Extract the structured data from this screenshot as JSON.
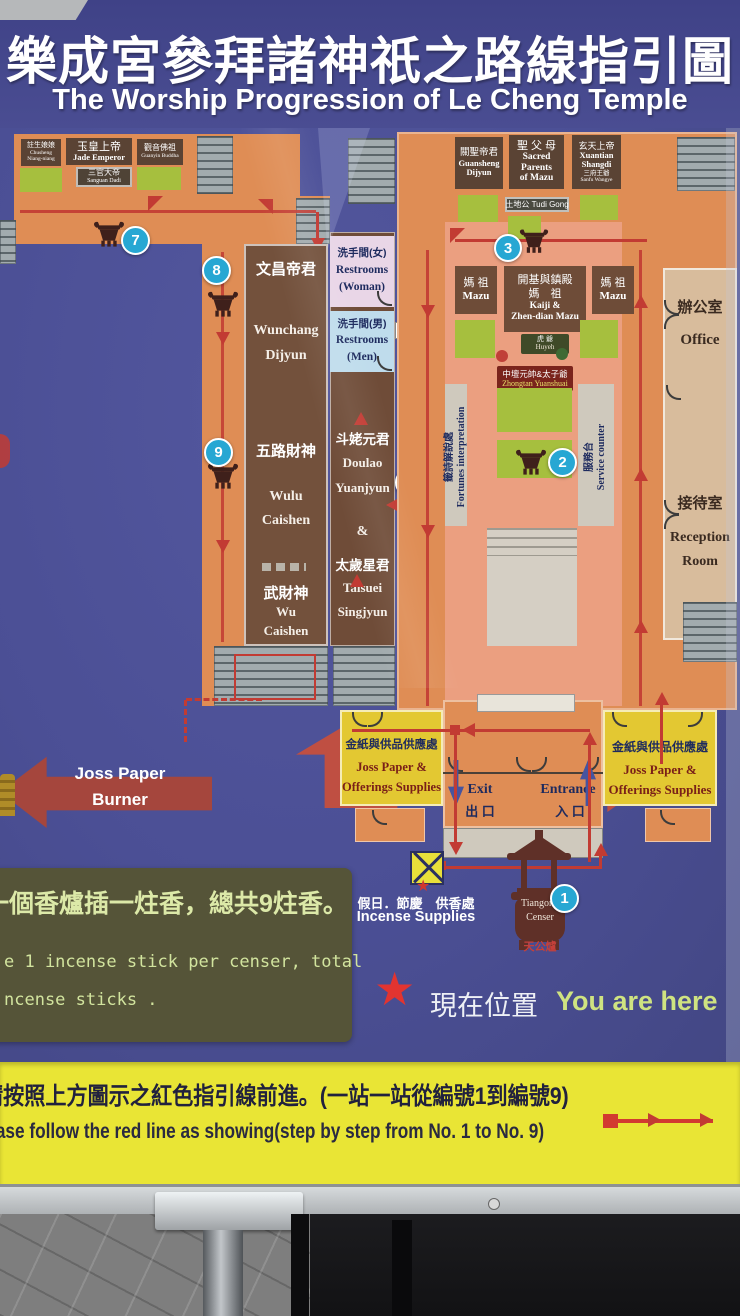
{
  "title": {
    "zh": "樂成宮參拜諸神祇之路線指引圖",
    "en": "The Worship Progression of Le Cheng Temple"
  },
  "left_wing": {
    "deities": [
      {
        "zh": "註生娘娘",
        "en1": "Chusheng",
        "en2": "Niang-niang"
      },
      {
        "zh": "玉皇上帝",
        "en": "Jade Emperor"
      },
      {
        "zh": "觀音佛祖",
        "en": "Guanyin Buddha"
      },
      {
        "zh": "三官大帝",
        "en": "Sanguan Dadi"
      }
    ],
    "hall": {
      "wunchang_zh": "文昌帝君",
      "wunchang_en1": "Wunchang",
      "wunchang_en2": "Dijyun",
      "wulu_zh": "五路財神",
      "wulu_en1": "Wulu",
      "wulu_en2": "Caishen",
      "wu_zh": "武財神",
      "wu_en1": "Wu",
      "wu_en2": "Caishen"
    },
    "floor_2f": "2F",
    "floor_1f": "1F",
    "joss_burner1": "Joss Paper",
    "joss_burner2": "Burner"
  },
  "middle": {
    "restroom_w_zh": "洗手間(女)",
    "restroom_w_en1": "Restrooms",
    "restroom_w_en2": "(Woman)",
    "restroom_m_zh": "洗手間(男)",
    "restroom_m_en1": "Restrooms",
    "restroom_m_en2": "(Men)",
    "doulao_zh": "斗姥元君",
    "doulao_en1": "Doulao",
    "doulao_en2": "Yuanjyun",
    "amp": "&",
    "taisuei_zh": "太歲星君",
    "taisuei_en1": "Taisuei",
    "taisuei_en2": "Singjyun"
  },
  "right_wing": {
    "guansheng": {
      "zh": "關聖帝君",
      "en1": "Guansheng",
      "en2": "Dijyun"
    },
    "parents": {
      "zh": "聖 父 母",
      "en1": "Sacred",
      "en2": "Parents",
      "en3": "of Mazu"
    },
    "xuantian": {
      "zh": "玄天上帝",
      "en1": "Xuantian",
      "en2": "Shangdi",
      "zh2": "三府王爺",
      "en3": "Sanfu Wangye"
    },
    "tudi": "土地公 Tudi Gong",
    "mazu_zh": "媽 祖",
    "mazu_en": "Mazu",
    "kaiji": {
      "zh1": "開基與鎮殿",
      "zh2": "媽　祖",
      "en1": "Kaiji &",
      "en2": "Zhen-dian Mazu"
    },
    "huyeh_zh": "虎 爺",
    "huyeh_en": "Huyeh",
    "zhongtan_zh": "中壇元帥&太子爺",
    "zhongtan_en": "Zhongtan Yuanshuai",
    "fortunes_zh": "籤詩解說處",
    "fortunes_en": "Fortunes interpretation",
    "service_zh": "服務台",
    "service_en": "Service counter",
    "office_zh": "辦公室",
    "office_en": "Office",
    "reception_zh": "接待室",
    "reception_en1": "Reception",
    "reception_en2": "Room"
  },
  "bottom": {
    "joss_zh": "金紙與供品供應處",
    "joss_en1": "Joss Paper &",
    "joss_en2": "Offerings Supplies",
    "exit_en": "Exit",
    "exit_zh": "出 口",
    "entrance_en": "Entrance",
    "entrance_zh": "入 口",
    "incense_zh": "假日．節慶　供香處",
    "incense_en": "Incense Supplies",
    "tiangong_en1": "Tiangong",
    "tiangong_en2": "Censer",
    "tiangong_zh": "天公爐"
  },
  "stations": {
    "s1": "1",
    "s2": "2",
    "s3": "3",
    "s4": "4",
    "s7": "7",
    "s8": "8",
    "s9": "9"
  },
  "notes": {
    "rule_zh": "一個香爐插一炷香，總共9炷香。",
    "rule_en1": "e 1 incense stick per censer, total",
    "rule_en2": "ncense sticks .",
    "here_zh": "現在位置",
    "here_en": "You are here"
  },
  "banner": {
    "zh": "請按照上方圖示之紅色指引線前進。(一站一站從編號1到編號9)",
    "en": "Please follow the red line as showing(step by step from No. 1 to No. 9)"
  },
  "colors": {
    "map_bg": "#4b4f95",
    "building_orange": "#df8d55",
    "hall_salmon": "#eb9f80",
    "station_blue": "#27a7d3",
    "path_red": "#c23b33",
    "banner_yellow": "#e9e535",
    "supplies_yellow": "#e3c832",
    "note_olive": "#555438",
    "note_text": "#d8e7a4"
  }
}
